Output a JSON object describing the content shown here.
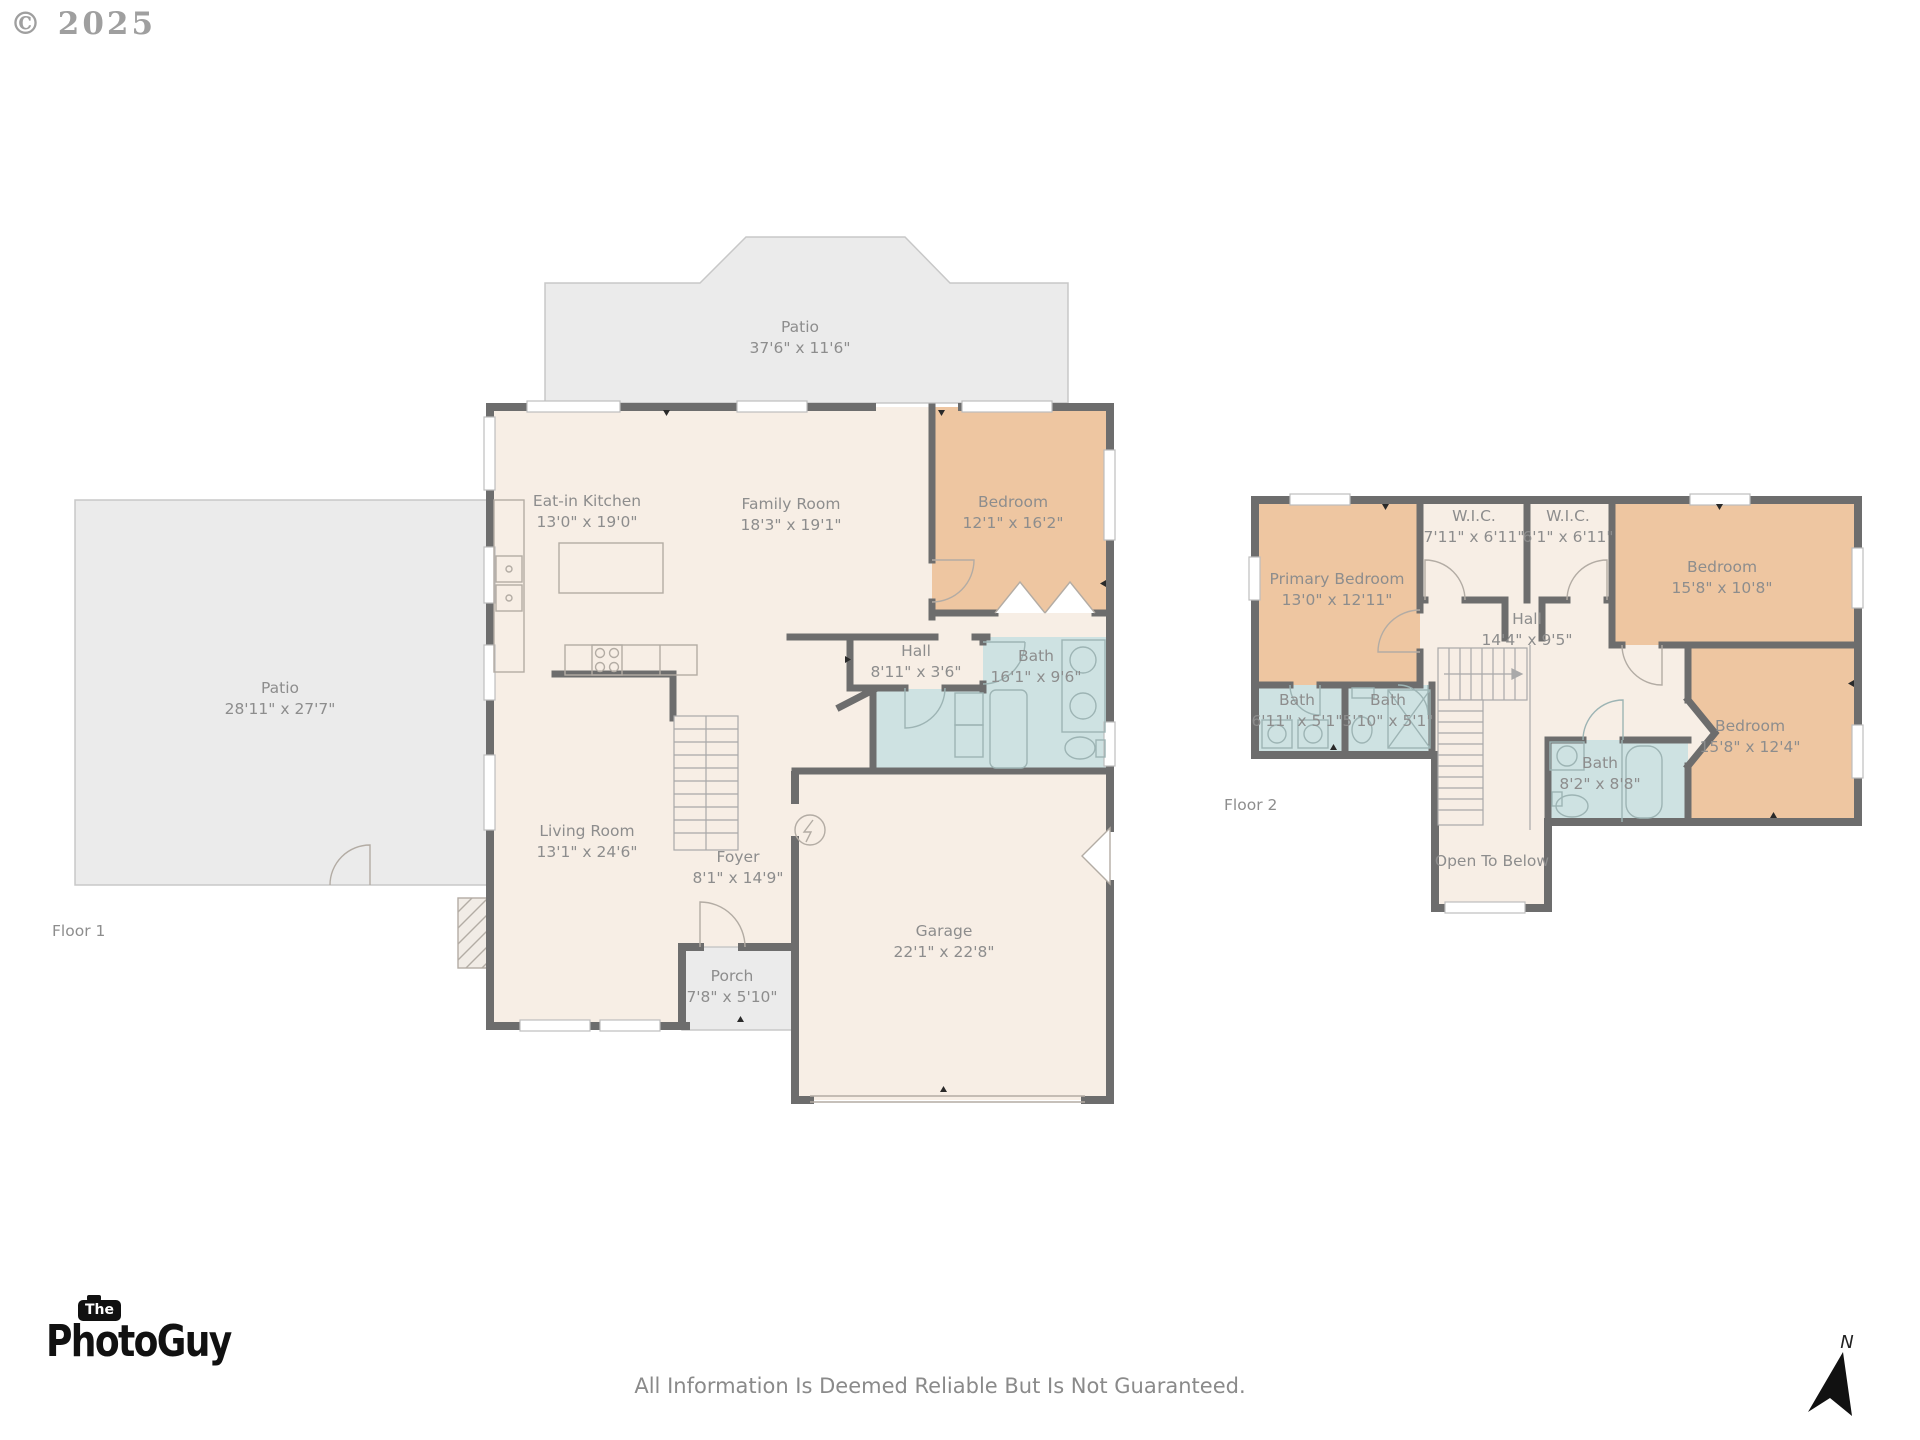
{
  "watermark": "© 2025",
  "floor1": {
    "label": "Floor 1",
    "rooms": {
      "patio_top": {
        "name": "Patio",
        "dims": "37'6\" x 11'6\""
      },
      "patio_left": {
        "name": "Patio",
        "dims": "28'11\" x 27'7\""
      },
      "kitchen": {
        "name": "Eat-in Kitchen",
        "dims": "13'0\" x 19'0\""
      },
      "family": {
        "name": "Family Room",
        "dims": "18'3\" x 19'1\""
      },
      "bedroom": {
        "name": "Bedroom",
        "dims": "12'1\" x 16'2\""
      },
      "hall": {
        "name": "Hall",
        "dims": "8'11\" x 3'6\""
      },
      "bath": {
        "name": "Bath",
        "dims": "16'1\" x 9'6\""
      },
      "living": {
        "name": "Living Room",
        "dims": "13'1\" x 24'6\""
      },
      "foyer": {
        "name": "Foyer",
        "dims": "8'1\" x 14'9\""
      },
      "garage": {
        "name": "Garage",
        "dims": "22'1\" x 22'8\""
      },
      "porch": {
        "name": "Porch",
        "dims": "7'8\" x 5'10\""
      }
    }
  },
  "floor2": {
    "label": "Floor 2",
    "rooms": {
      "primary": {
        "name": "Primary Bedroom",
        "dims": "13'0\" x 12'11\""
      },
      "wic1": {
        "name": "W.I.C.",
        "dims": "7'11\" x 6'11\""
      },
      "wic2": {
        "name": "W.I.C.",
        "dims": "6'1\" x 6'11\""
      },
      "bedroom_tr": {
        "name": "Bedroom",
        "dims": "15'8\" x 10'8\""
      },
      "hall": {
        "name": "Hall",
        "dims": "14'4\" x 9'5\""
      },
      "bath1": {
        "name": "Bath",
        "dims": "6'11\" x 5'1\""
      },
      "bath2": {
        "name": "Bath",
        "dims": "5'10\" x 5'1\""
      },
      "bath3": {
        "name": "Bath",
        "dims": "8'2\" x 8'8\""
      },
      "bedroom_br": {
        "name": "Bedroom",
        "dims": "15'8\" x 12'4\""
      },
      "open_below": {
        "name": "Open To Below"
      }
    }
  },
  "footer": {
    "logo_the": "The",
    "logo_name": "PhotoGuy",
    "disclaimer": "All Information Is Deemed Reliable But Is Not Guaranteed.",
    "north": "N"
  }
}
